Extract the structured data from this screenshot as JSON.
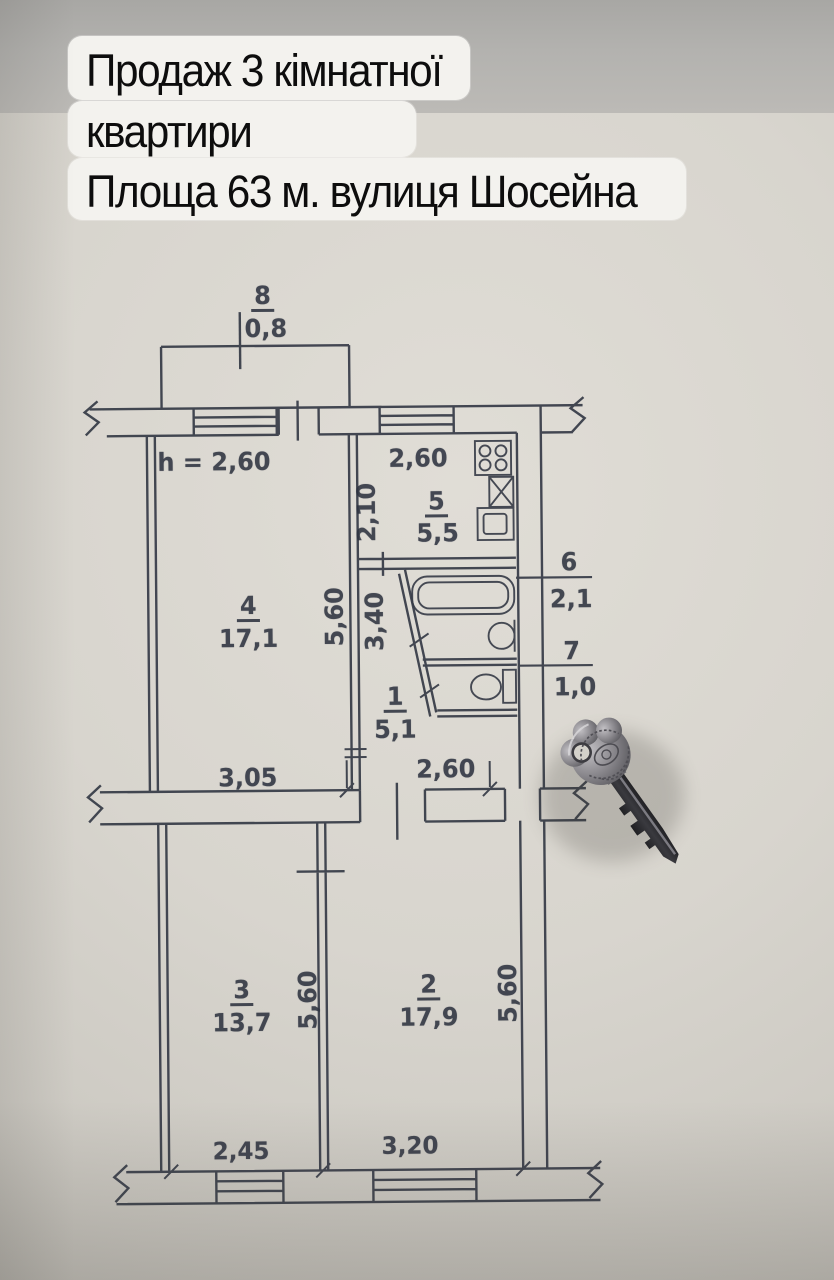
{
  "overlay": {
    "line1": "Продаж 3 кімнатної",
    "line2": "квартири",
    "line3": "Площа 63 м. вулиця Шосейна"
  },
  "plan": {
    "ceiling_height": "h = 2,60",
    "rooms": {
      "r1": {
        "number": "1",
        "area": "5,1"
      },
      "r2": {
        "number": "2",
        "area": "17,9"
      },
      "r3": {
        "number": "3",
        "area": "13,7"
      },
      "r4": {
        "number": "4",
        "area": "17,1"
      },
      "r5": {
        "number": "5",
        "area": "5,5"
      },
      "r6": {
        "number": "6",
        "area": "2,1"
      },
      "r7": {
        "number": "7",
        "area": "1,0"
      },
      "r8": {
        "number": "8",
        "area": "0,8"
      }
    },
    "dims": {
      "kitchen_width": "2,60",
      "kitchen_depth": "2,10",
      "room4_width": "3,05",
      "room4_depth": "5,60",
      "hall_depth": "3,40",
      "hall_width": "2,60",
      "room3_width": "2,45",
      "room3_depth": "5,60",
      "room2_width": "3,20",
      "room2_depth": "5,60"
    }
  },
  "colors": {
    "ink": "#353a46",
    "paper": "#d8d5ce",
    "backdrop": "#b3b2af",
    "highlight_block": "#f3f2ee",
    "key_metal": "#8a888d",
    "key_blade": "#2b2b2e"
  }
}
